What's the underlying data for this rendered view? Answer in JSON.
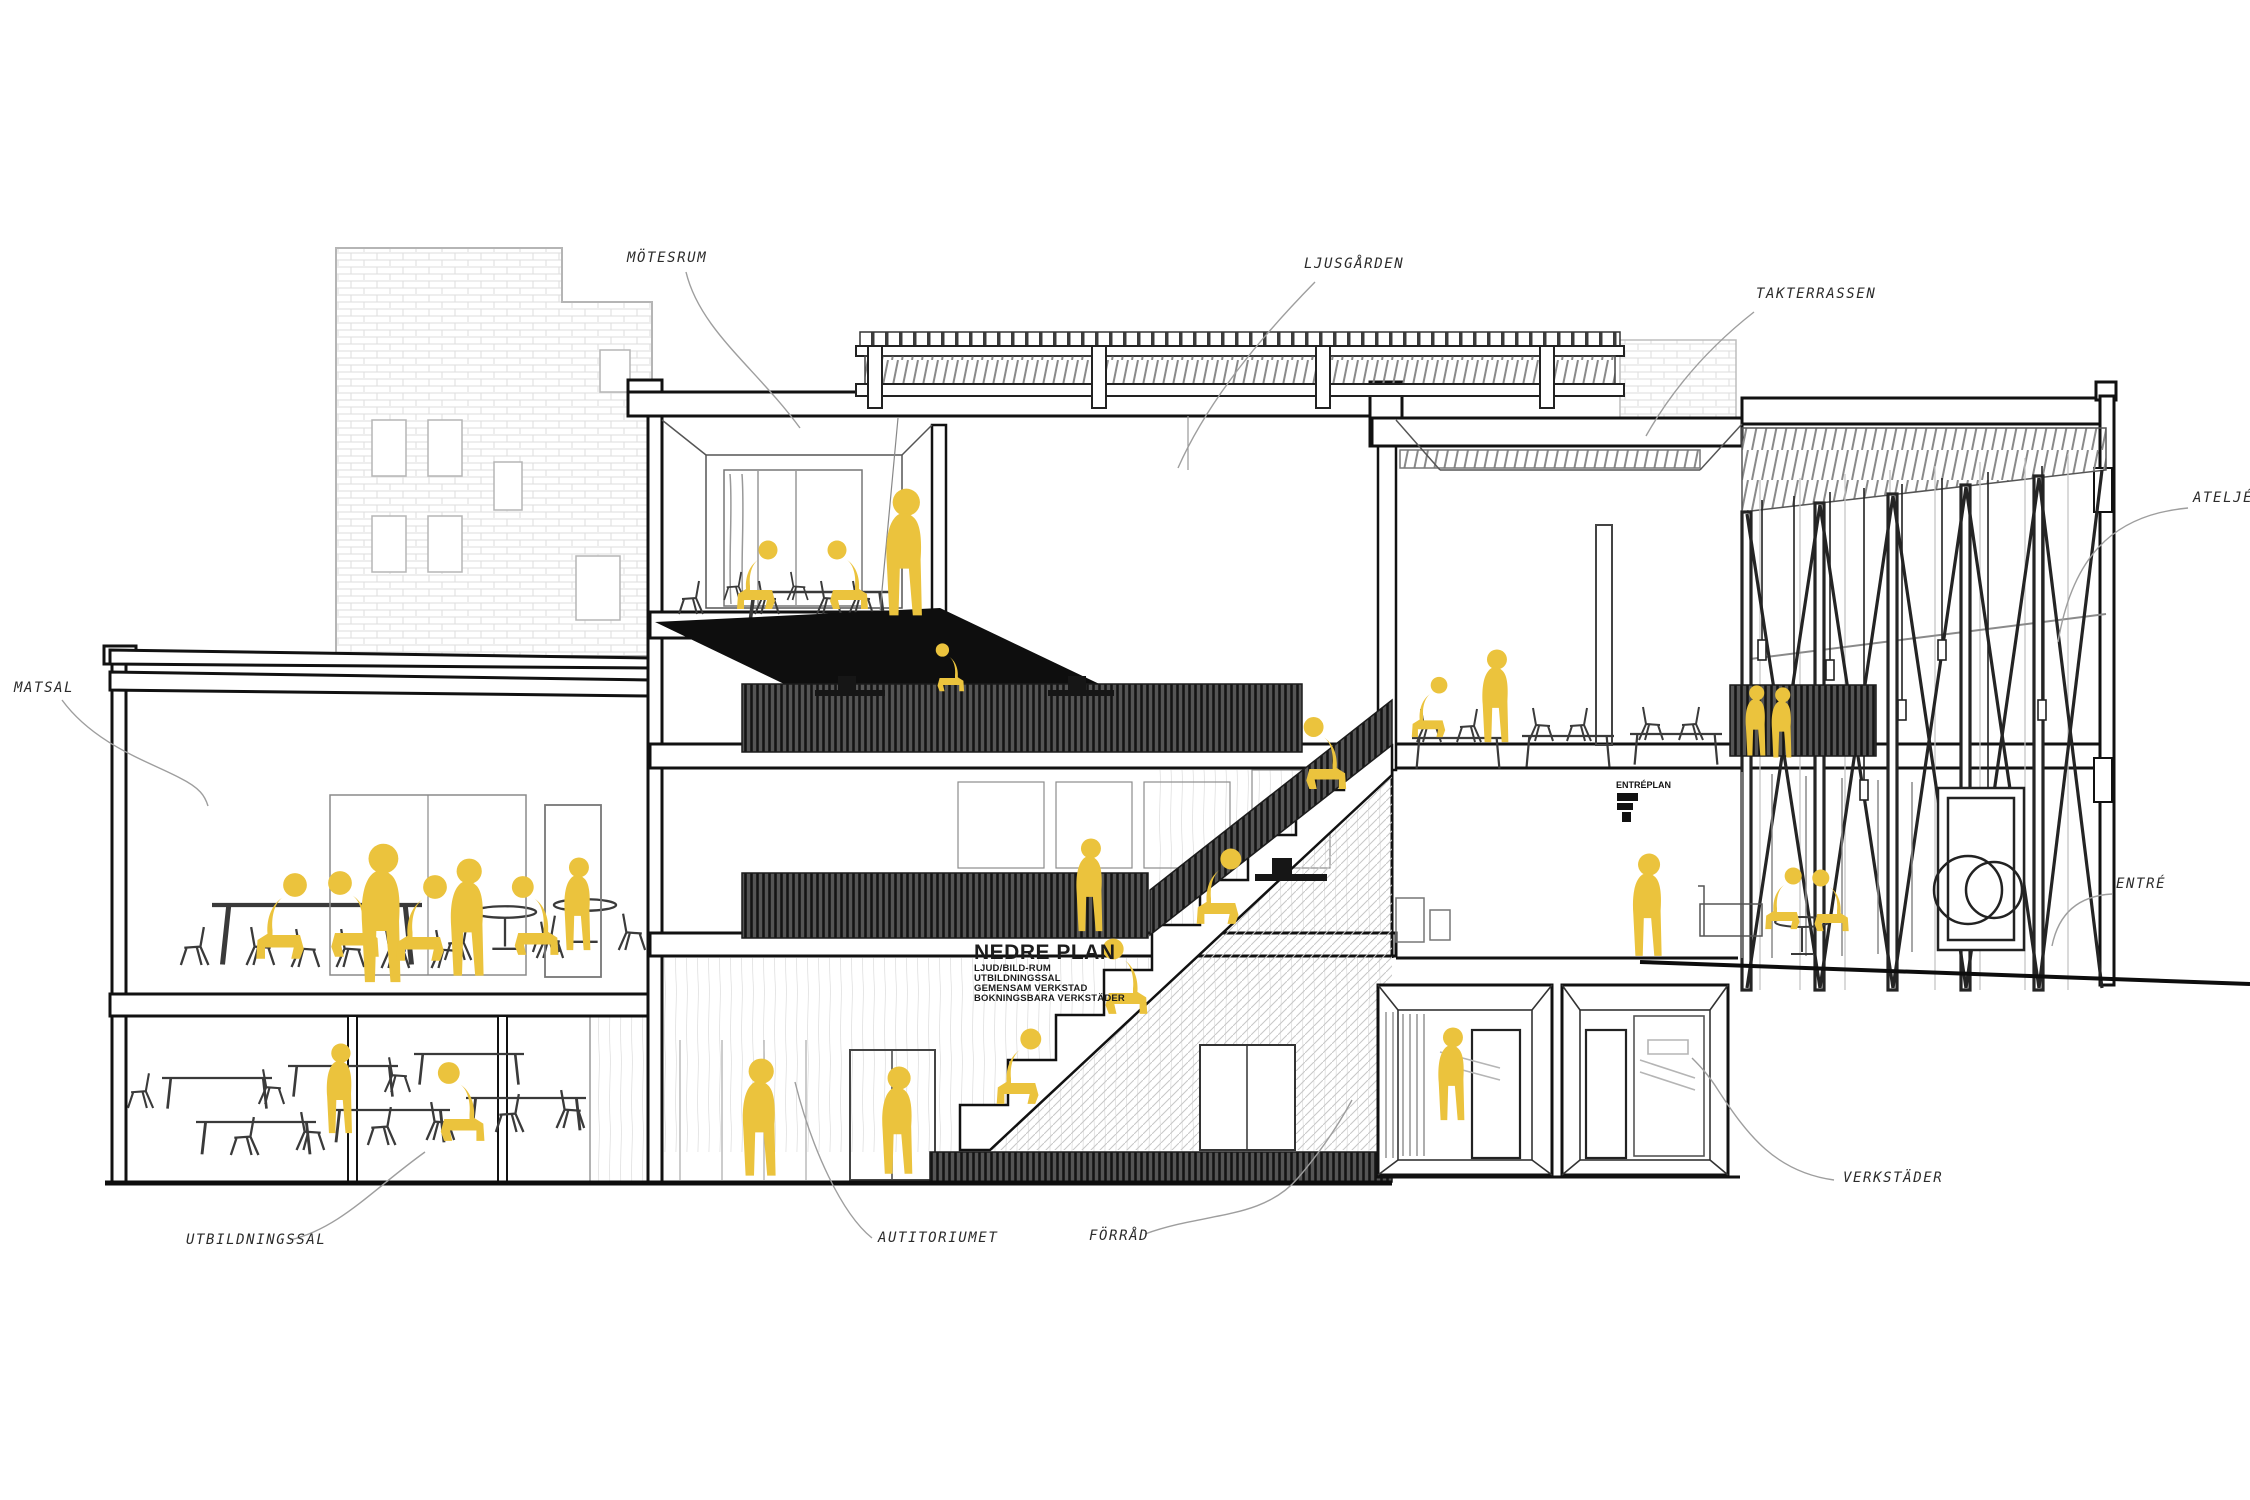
{
  "drawing": {
    "kind": "architectural cross-section perspective",
    "figure_color": "#EBC33D",
    "line_color": "#1A1A1A",
    "slat_dark": "#4A4A4A",
    "leader_color": "#9E9E9E"
  },
  "labels": {
    "motesrum": "MÖTESRUM",
    "ljusgarden": "LJUSGÅRDEN",
    "takterrassen": "TAKTERRASSEN",
    "atelje": "ATELJÉ",
    "matsal": "MATSAL",
    "entre": "ENTRÉ",
    "utbildningssal": "UTBILDNINGSSAL",
    "autitoriumet": "AUTITORIUMET",
    "forrad": "FÖRRÅD",
    "verkstader": "VERKSTÄDER"
  },
  "floor_plan_note": {
    "title": "NEDRE PLAN",
    "lines": [
      "LJUD/BILD-RUM",
      "UTBILDNINGSSAL",
      "GEMENSAM VERKSTAD",
      "BOKNINGSBARA VERKSTÄDER"
    ]
  },
  "wall_sign": {
    "text": "ENTRÉPLAN"
  }
}
